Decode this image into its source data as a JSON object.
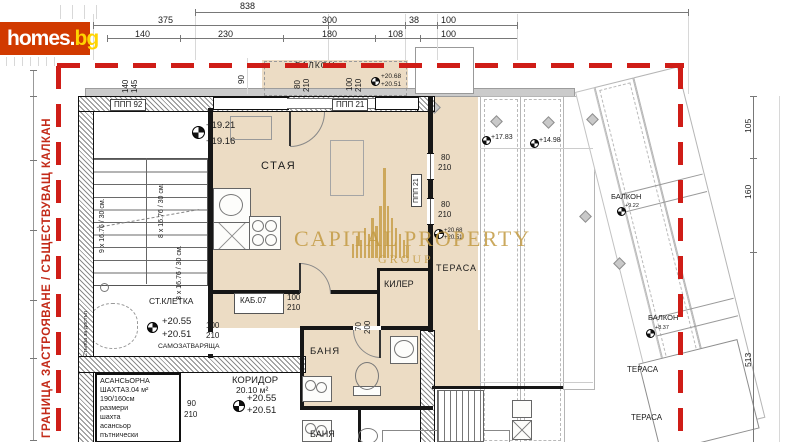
{
  "site": {
    "logo_main": "homes.",
    "logo_tld": "bg"
  },
  "boundary_text": "ГРАНИЦА ЗАСТРОЯВАНЕ / СЪЩЕСТВУВАЩ КАЛКАН",
  "watermark": {
    "word1": "CAPITAL",
    "word2": "PROPERTY",
    "word3": "GROUP",
    "bars": [
      14,
      22,
      18,
      30,
      24,
      40,
      32,
      52,
      90,
      52,
      40,
      30,
      24,
      18,
      12
    ]
  },
  "colors": {
    "boundary_red": "#c8241a",
    "logo_bg": "#d13a00",
    "logo_accent": "#ffd400",
    "floor_beige": "#ecdcc4",
    "watermark_gold": "#c39b43"
  },
  "labels": [
    {
      "n": "dim-838",
      "t": "838",
      "x": 240,
      "y": 2,
      "s": 9
    },
    {
      "n": "dim-375",
      "t": "375",
      "x": 158,
      "y": 16,
      "s": 9
    },
    {
      "n": "dim-300",
      "t": "300",
      "x": 322,
      "y": 16,
      "s": 9
    },
    {
      "n": "dim-38",
      "t": "38",
      "x": 409,
      "y": 16,
      "s": 9
    },
    {
      "n": "dim-100-a",
      "t": "100",
      "x": 441,
      "y": 16,
      "s": 9
    },
    {
      "n": "dim-140",
      "t": "140",
      "x": 135,
      "y": 30,
      "s": 9
    },
    {
      "n": "dim-230",
      "t": "230",
      "x": 218,
      "y": 30,
      "s": 9
    },
    {
      "n": "dim-180",
      "t": "180",
      "x": 322,
      "y": 30,
      "s": 9
    },
    {
      "n": "dim-108",
      "t": "108",
      "x": 388,
      "y": 30,
      "s": 9
    },
    {
      "n": "dim-100-b",
      "t": "100",
      "x": 441,
      "y": 30,
      "s": 9
    },
    {
      "n": "dim-140-v",
      "t": "140",
      "x": 122,
      "y": 93,
      "s": 8,
      "rot": 1
    },
    {
      "n": "dim-145-v",
      "t": "145",
      "x": 131,
      "y": 93,
      "s": 8,
      "rot": 1
    },
    {
      "n": "dim-90-v",
      "t": "90",
      "x": 238,
      "y": 84,
      "s": 8,
      "rot": 1
    },
    {
      "n": "dim-80-v",
      "t": "80",
      "x": 294,
      "y": 89,
      "s": 8,
      "rot": 1
    },
    {
      "n": "dim-210-v",
      "t": "210",
      "x": 303,
      "y": 92,
      "s": 8,
      "rot": 1
    },
    {
      "n": "dim-100-v",
      "t": "100",
      "x": 346,
      "y": 91,
      "s": 8,
      "rot": 1
    },
    {
      "n": "dim-210-v2",
      "t": "210",
      "x": 355,
      "y": 92,
      "s": 8,
      "rot": 1
    },
    {
      "n": "lvl-2068-top",
      "t": "+20.68",
      "x": 381,
      "y": 74,
      "s": 6.5
    },
    {
      "n": "lvl-2051-top",
      "t": "+20.51",
      "x": 381,
      "y": 82,
      "s": 6.5
    },
    {
      "n": "label-balkon-top",
      "t": "БАЛКОН",
      "x": 295,
      "y": 61,
      "s": 8.5,
      "ls": 1
    },
    {
      "n": "label-ppp92",
      "t": "ППП 92",
      "x": 110,
      "y": 99,
      "s": 8,
      "tag": 1
    },
    {
      "n": "label-ppp21",
      "t": "ППП 21",
      "x": 332,
      "y": 99,
      "s": 8,
      "tag": 1
    },
    {
      "n": "label-ppp21-v",
      "t": "ППП 21",
      "x": 411,
      "y": 207,
      "s": 7,
      "rot": 1,
      "tag": 1
    },
    {
      "n": "lvl-1921",
      "t": "+19.21",
      "x": 206,
      "y": 121,
      "s": 9.5
    },
    {
      "n": "lvl-1916",
      "t": "+19.16",
      "x": 206,
      "y": 137,
      "s": 9.5
    },
    {
      "n": "label-staya",
      "t": "СТАЯ",
      "x": 261,
      "y": 161,
      "s": 11,
      "ls": 1.5
    },
    {
      "n": "stair-9x",
      "t": "9 x 16.76 / 30 см.",
      "x": 99,
      "y": 253,
      "s": 7,
      "rot": 1
    },
    {
      "n": "stair-8x-a",
      "t": "8 x 16.76 / 30 см.",
      "x": 158,
      "y": 238,
      "s": 7,
      "rot": 1
    },
    {
      "n": "stair-8x-b",
      "t": "8 x 16.76 / 30 см.",
      "x": 176,
      "y": 300,
      "s": 7,
      "rot": 1
    },
    {
      "n": "label-kab07",
      "t": "КАБ.07",
      "x": 240,
      "y": 297,
      "s": 8
    },
    {
      "n": "dim-100-kab",
      "t": "100",
      "x": 287,
      "y": 294,
      "s": 8
    },
    {
      "n": "dim-210-kab",
      "t": "210",
      "x": 287,
      "y": 304,
      "s": 8
    },
    {
      "n": "label-kiler",
      "t": "КИЛЕР",
      "x": 384,
      "y": 280,
      "s": 9
    },
    {
      "n": "dim-70-v",
      "t": "70",
      "x": 355,
      "y": 331,
      "s": 8,
      "rot": 1
    },
    {
      "n": "dim-200-v",
      "t": "200",
      "x": 364,
      "y": 334,
      "s": 8,
      "rot": 1
    },
    {
      "n": "label-terasa",
      "t": "ТЕРАСА",
      "x": 436,
      "y": 264,
      "s": 9,
      "ls": 1
    },
    {
      "n": "dim-80-w1",
      "t": "80",
      "x": 441,
      "y": 154,
      "s": 8
    },
    {
      "n": "dim-210-w1",
      "t": "210",
      "x": 438,
      "y": 164,
      "s": 8
    },
    {
      "n": "dim-80-w2",
      "t": "80",
      "x": 441,
      "y": 201,
      "s": 8
    },
    {
      "n": "dim-210-w2",
      "t": "210",
      "x": 438,
      "y": 211,
      "s": 8
    },
    {
      "n": "lvl-2068-ter",
      "t": "+20.68",
      "x": 444,
      "y": 228,
      "s": 6
    },
    {
      "n": "lvl-2051-ter",
      "t": "+20.51",
      "x": 444,
      "y": 235,
      "s": 6
    },
    {
      "n": "lvl-1783",
      "t": "+17.83",
      "x": 491,
      "y": 134,
      "s": 7
    },
    {
      "n": "lvl-1498",
      "t": "+14.98",
      "x": 539,
      "y": 137,
      "s": 7
    },
    {
      "n": "label-banya",
      "t": "БАНЯ",
      "x": 310,
      "y": 347,
      "s": 9.5,
      "ls": 1
    },
    {
      "n": "label-stkletka",
      "t": "СТ.КЛЕТКА",
      "x": 149,
      "y": 297,
      "s": 8.5
    },
    {
      "n": "lvl-2055-st",
      "t": "+20.55",
      "x": 162,
      "y": 317,
      "s": 9.5
    },
    {
      "n": "lvl-2051-st",
      "t": "+20.51",
      "x": 162,
      "y": 330,
      "s": 9.5
    },
    {
      "n": "dim-100-st",
      "t": "100",
      "x": 206,
      "y": 322,
      "s": 8
    },
    {
      "n": "dim-210-st",
      "t": "210",
      "x": 206,
      "y": 332,
      "s": 8
    },
    {
      "n": "label-samozat",
      "t": "САМОЗАТВАРЯЩА",
      "x": 158,
      "y": 344,
      "s": 6.8
    },
    {
      "n": "label-koridor",
      "t": "КОРИДОР",
      "x": 232,
      "y": 376,
      "s": 9.5
    },
    {
      "n": "label-koridor-area",
      "t": "20.10 м²",
      "x": 236,
      "y": 386,
      "s": 8.5
    },
    {
      "n": "lvl-2055-kor",
      "t": "+20.55",
      "x": 247,
      "y": 394,
      "s": 9.5
    },
    {
      "n": "lvl-2051-kor",
      "t": "+20.51",
      "x": 247,
      "y": 406,
      "s": 9.5
    },
    {
      "n": "dim-90-lift",
      "t": "90",
      "x": 187,
      "y": 400,
      "s": 8
    },
    {
      "n": "dim-210-lift",
      "t": "210",
      "x": 184,
      "y": 411,
      "s": 8
    },
    {
      "n": "label-banya-lower",
      "t": "БАНЯ",
      "x": 310,
      "y": 430,
      "s": 9
    },
    {
      "n": "lift-line-1",
      "t": "АСАНСЬОРНА",
      "x": 100,
      "y": 377,
      "s": 7.2
    },
    {
      "n": "lift-line-2",
      "t": "ШАХТА3.04 м²",
      "x": 100,
      "y": 386,
      "s": 7.2
    },
    {
      "n": "lift-line-3",
      "t": "190/160см",
      "x": 100,
      "y": 395,
      "s": 7.2
    },
    {
      "n": "lift-line-4",
      "t": "размери",
      "x": 100,
      "y": 404,
      "s": 7.2
    },
    {
      "n": "lift-line-5",
      "t": "шахта",
      "x": 100,
      "y": 413,
      "s": 7.2
    },
    {
      "n": "lift-line-6",
      "t": "асансьор",
      "x": 100,
      "y": 422,
      "s": 7.2
    },
    {
      "n": "lift-line-7",
      "t": "пътнически",
      "x": 100,
      "y": 431,
      "s": 7.2
    },
    {
      "n": "label-balkon-r1",
      "t": "БАЛКОН",
      "x": 611,
      "y": 193,
      "s": 7.5
    },
    {
      "n": "lvl-922",
      "t": "+9.22",
      "x": 625,
      "y": 204,
      "s": 5.5
    },
    {
      "n": "label-balkon-r2",
      "t": "БАЛКОН",
      "x": 648,
      "y": 314,
      "s": 7.5
    },
    {
      "n": "lvl-837",
      "t": "+8.37",
      "x": 655,
      "y": 326,
      "s": 5.5
    },
    {
      "n": "label-terasa-r1",
      "t": "ТЕРАСА",
      "x": 627,
      "y": 366,
      "s": 8
    },
    {
      "n": "label-terasa-r2",
      "t": "ТЕРАСА",
      "x": 631,
      "y": 414,
      "s": 8
    },
    {
      "n": "dim-105-v",
      "t": "105",
      "x": 744,
      "y": 133,
      "s": 8.5,
      "rot": 1
    },
    {
      "n": "dim-160-v",
      "t": "160",
      "x": 744,
      "y": 199,
      "s": 8.5,
      "rot": 1
    },
    {
      "n": "dim-513-v",
      "t": "513",
      "x": 744,
      "y": 367,
      "s": 8.5,
      "rot": 1
    },
    {
      "n": "label-stalba",
      "t": "Стълба за достъп",
      "x": 84,
      "y": 357,
      "s": 5.5,
      "rot": 1
    }
  ],
  "markers": [
    {
      "n": "lvl-marker-stairs",
      "x": 192,
      "y": 126,
      "d": 11
    },
    {
      "n": "lvl-marker-stkletka",
      "x": 147,
      "y": 322,
      "d": 9
    },
    {
      "n": "lvl-marker-koridor",
      "x": 233,
      "y": 400,
      "d": 10
    },
    {
      "n": "lvl-marker-balkon-top",
      "x": 371,
      "y": 77,
      "d": 7
    },
    {
      "n": "lvl-marker-terasa",
      "x": 434,
      "y": 229,
      "d": 8
    },
    {
      "n": "lvl-marker-1783",
      "x": 482,
      "y": 136,
      "d": 7
    },
    {
      "n": "lvl-marker-1498",
      "x": 530,
      "y": 139,
      "d": 7
    },
    {
      "n": "lvl-marker-balkon-r1",
      "x": 617,
      "y": 207,
      "d": 7
    },
    {
      "n": "lvl-marker-balkon-r2",
      "x": 646,
      "y": 329,
      "d": 7
    }
  ]
}
